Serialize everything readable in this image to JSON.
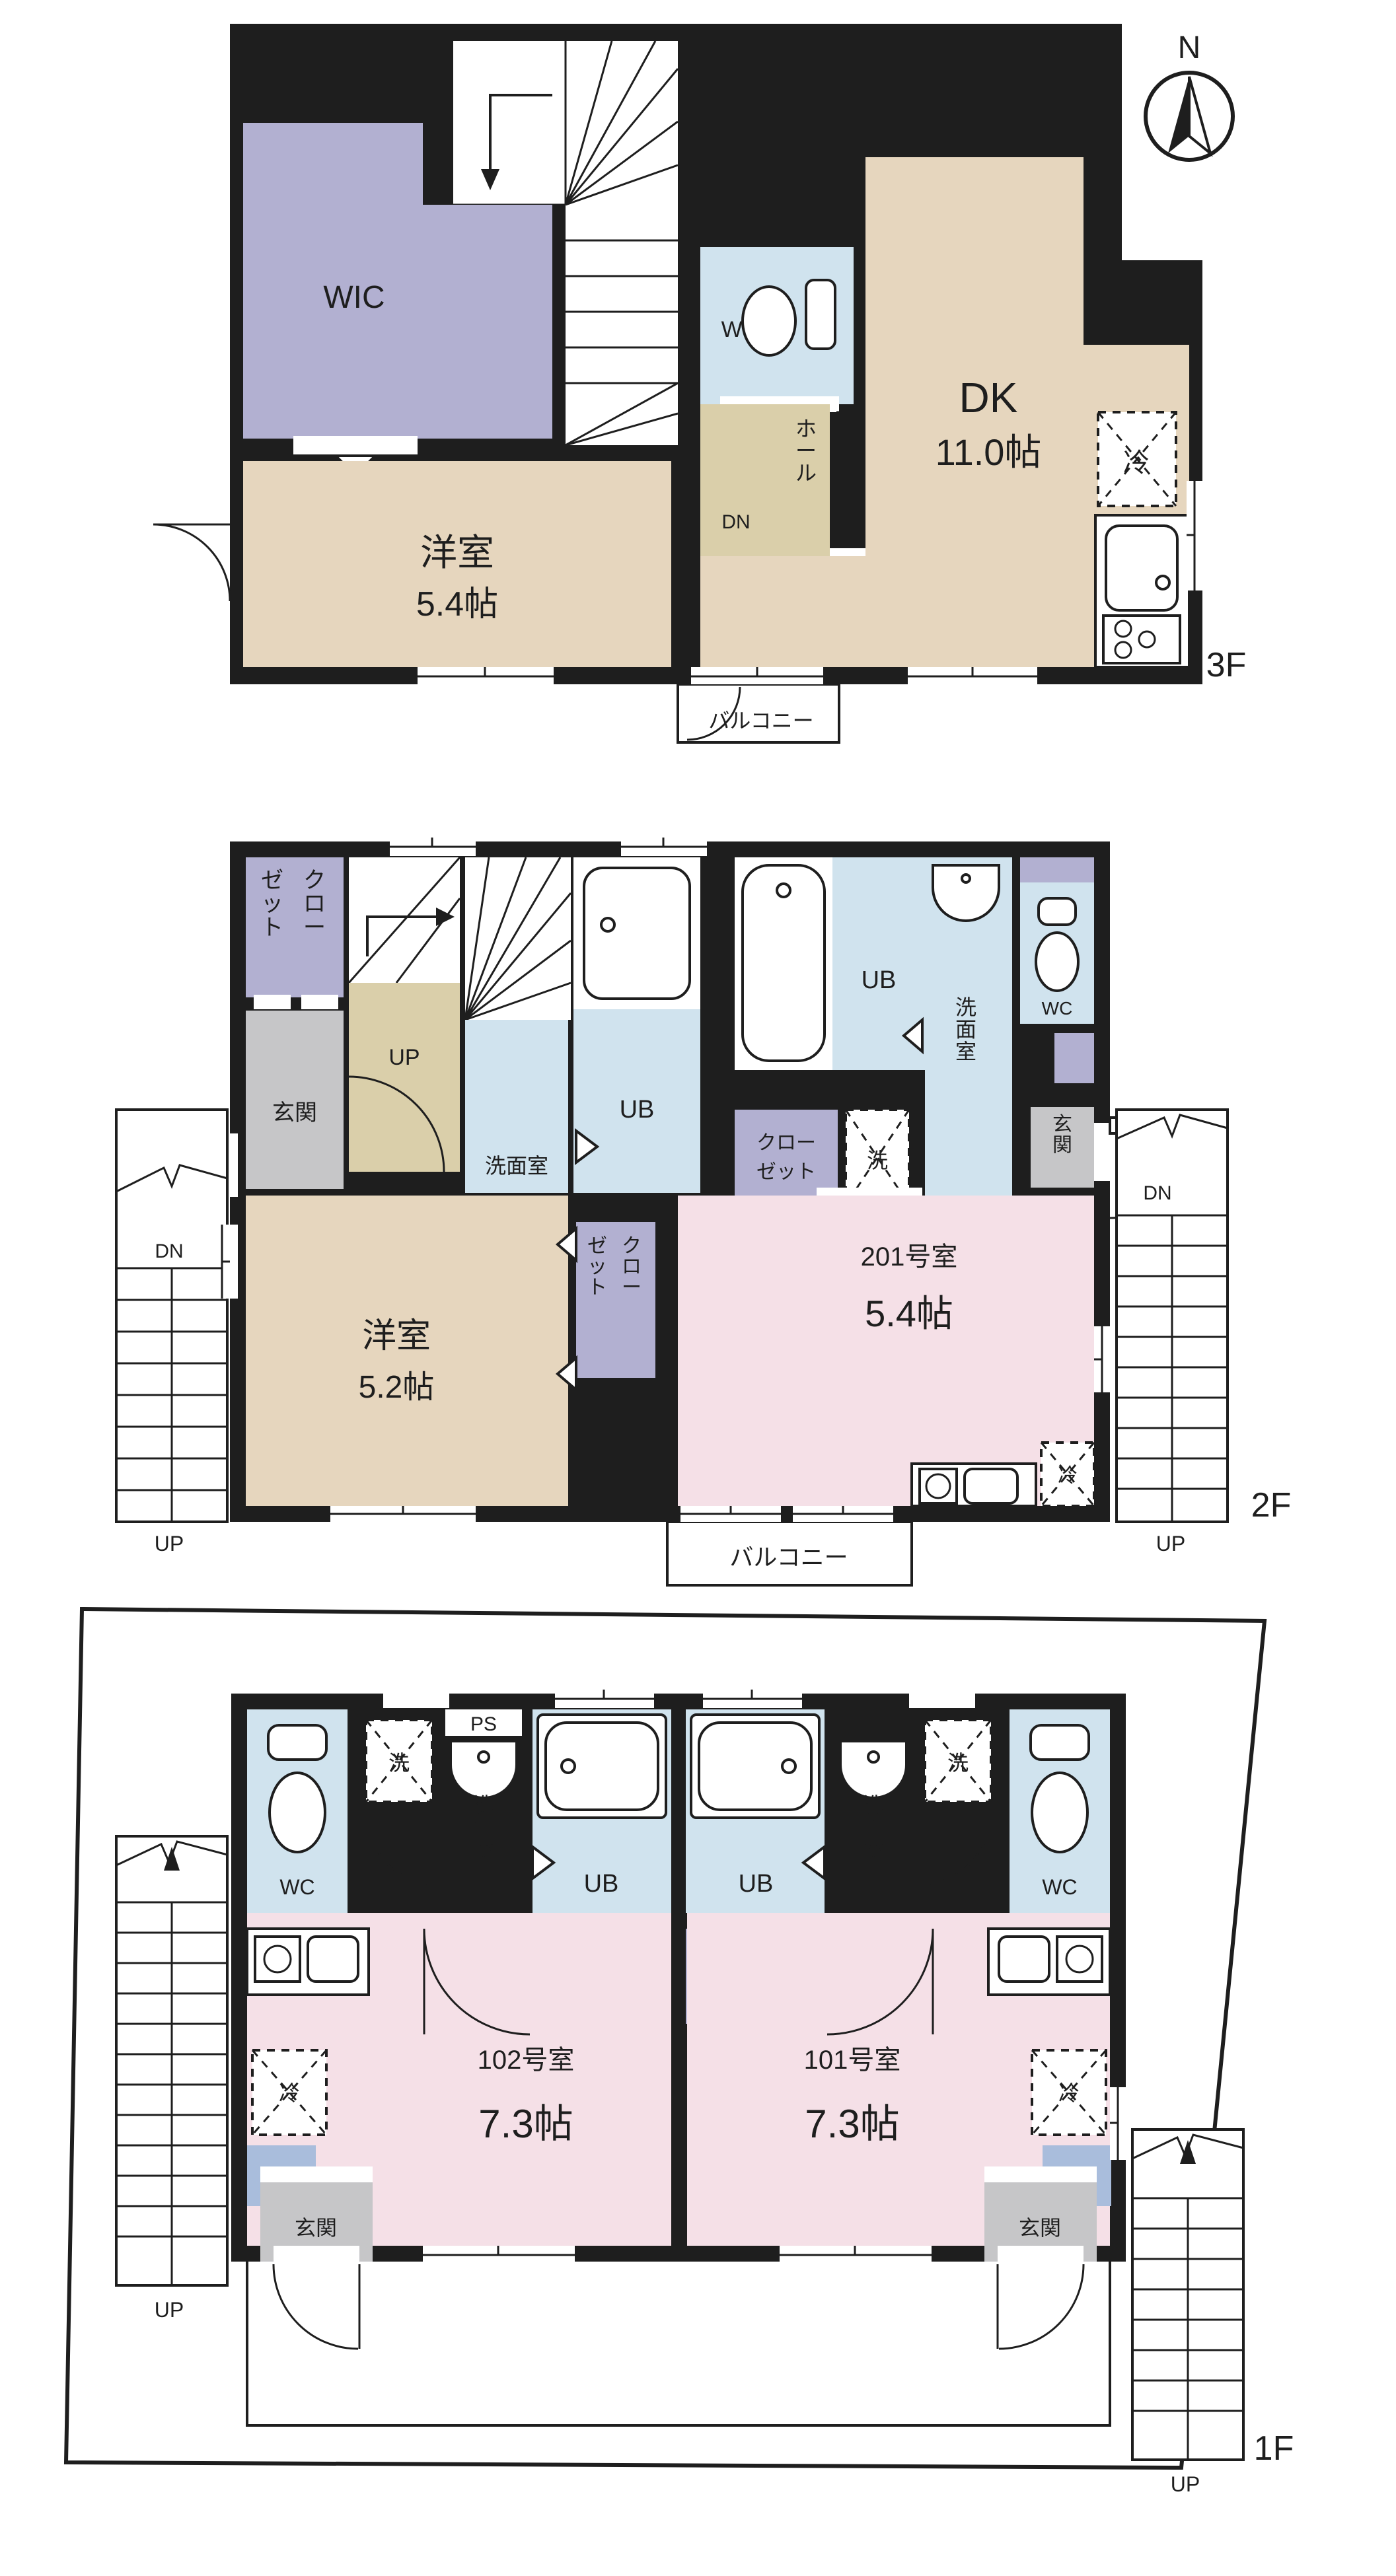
{
  "compass": {
    "n": "N"
  },
  "floors": {
    "f3": {
      "label": "3F",
      "wic": "WIC",
      "wc": "WC",
      "dn": "DN",
      "hall": "ホール",
      "dk": "DK",
      "dk_size": "11.0帖",
      "yoshitsu": "洋室",
      "yoshitsu_size": "5.4帖",
      "balcony": "バルコニー",
      "rei": "冷"
    },
    "f2": {
      "label": "2F",
      "closet_col_r": "クロー",
      "closet_col_l": "ゼット",
      "up": "UP",
      "genkan": "玄関",
      "ub": "UB",
      "sen": "洗",
      "senmen": "洗面室",
      "wc": "WC",
      "room": "201号室",
      "room_size": "5.4帖",
      "yoshitsu": "洋室",
      "yoshitsu_size": "5.2帖",
      "closet_line1": "クロー",
      "closet_line2": "ゼット",
      "balcony": "バルコニー",
      "rei": "冷",
      "dn": "DN"
    },
    "f1": {
      "label": "1F",
      "wc": "WC",
      "sen": "洗",
      "ps": "PS",
      "senmen": "洗面室",
      "ub": "UB",
      "closet_line1": "クロー",
      "closet_line2": "ゼット",
      "room102": "102号室",
      "room102_size": "7.3帖",
      "room101": "101号室",
      "room101_size": "7.3帖",
      "rei": "冷",
      "genkan": "玄関",
      "up": "UP"
    }
  }
}
